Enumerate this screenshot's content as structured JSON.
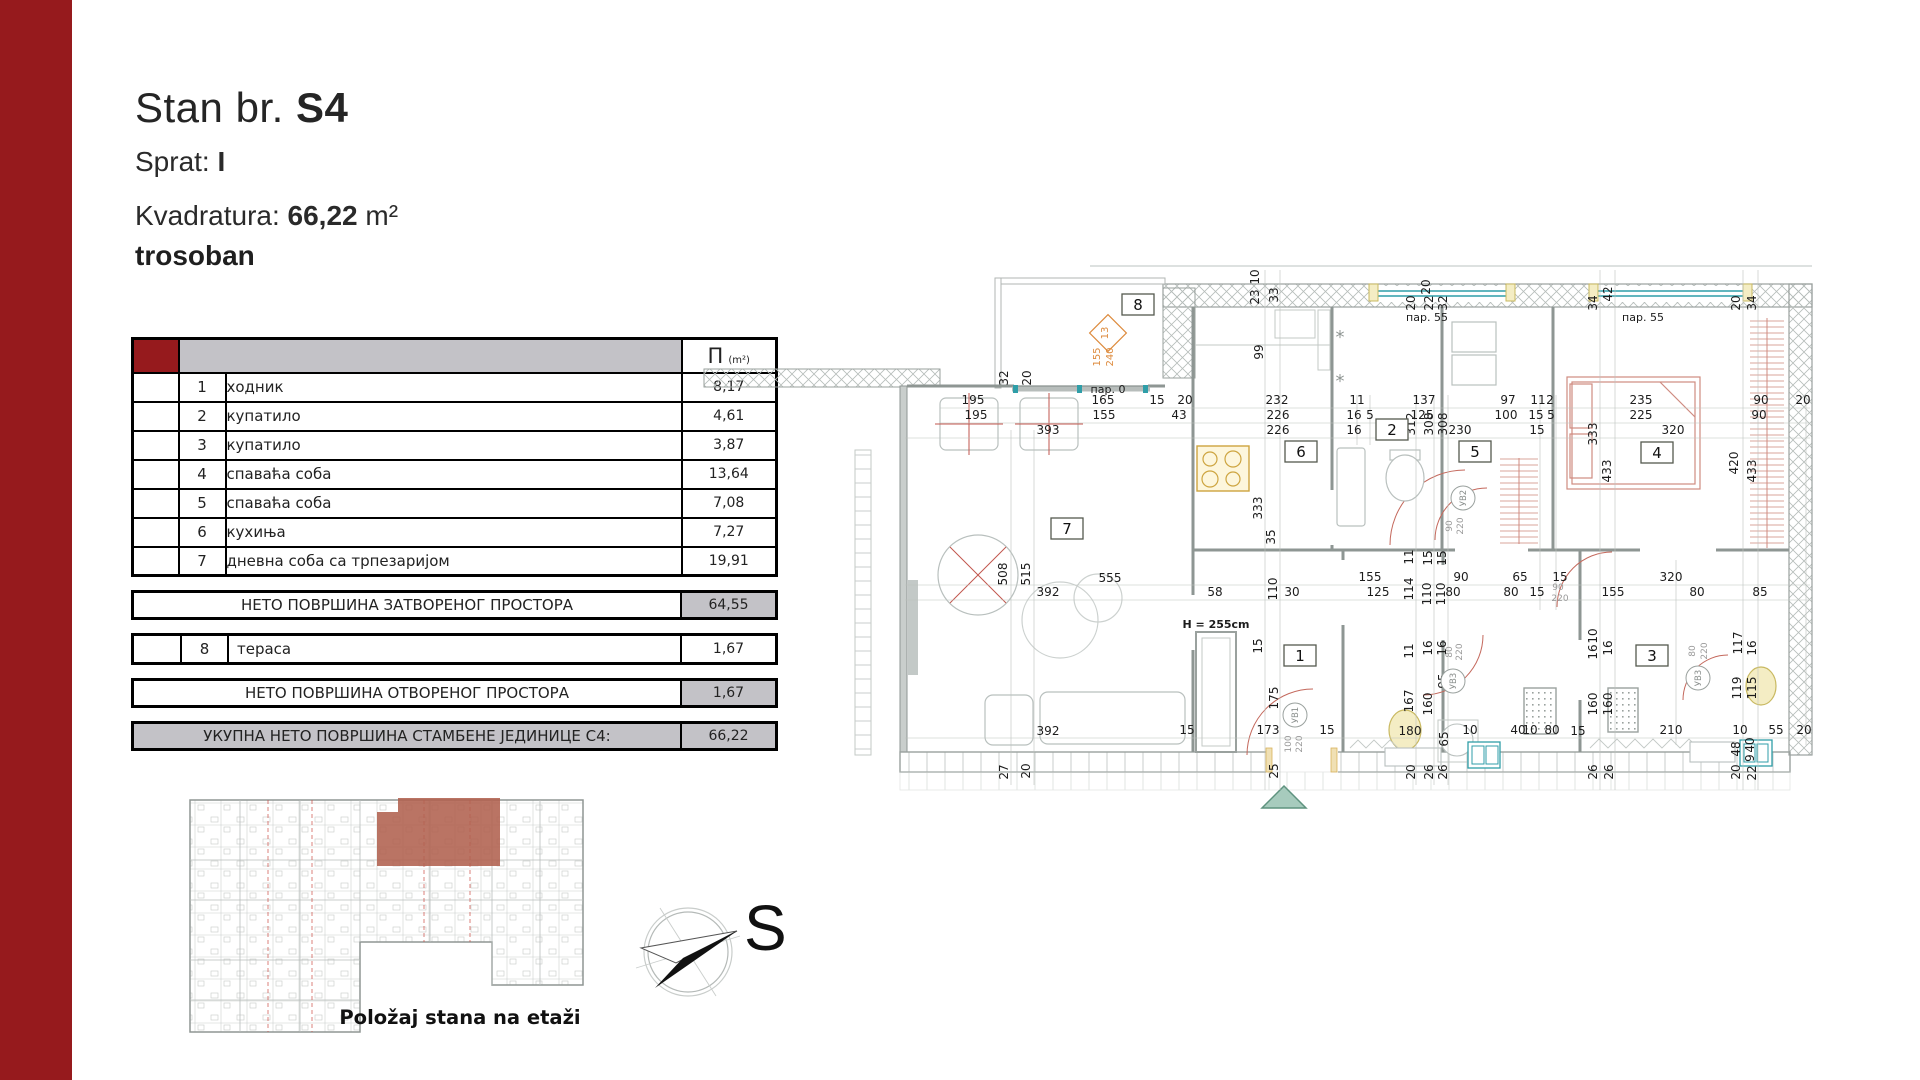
{
  "colors": {
    "accent": "#961a1d",
    "table_gray": "#c3c2c7",
    "highlight": "#b0614f",
    "teal": "#2f9ea8",
    "furniture_red": "#cf8b80",
    "fixture_yellow": "#f4edc4",
    "entry_green": "#a7cbbd"
  },
  "header": {
    "title_label": "Stan br.",
    "unit": "S4",
    "floor_label": "Sprat:",
    "floor": "I",
    "area_label": "Kvadratura:",
    "area": "66,22",
    "area_unit": "m²",
    "apartment_type": "trosoban"
  },
  "table": {
    "area_symbol": "П",
    "area_unit": "(m²)",
    "rows": [
      {
        "num": "1",
        "name": "ходник",
        "area": "8,17"
      },
      {
        "num": "2",
        "name": "купатило",
        "area": "4,61"
      },
      {
        "num": "3",
        "name": "купатило",
        "area": "3,87"
      },
      {
        "num": "4",
        "name": "спаваћа соба",
        "area": "13,64"
      },
      {
        "num": "5",
        "name": "спаваћа соба",
        "area": "7,08"
      },
      {
        "num": "6",
        "name": "кухиња",
        "area": "7,27"
      },
      {
        "num": "7",
        "name": "дневна соба са трпезаријом",
        "area": "19,91"
      }
    ],
    "closed_total": {
      "label": "НЕТО ПОВРШИНА ЗАТВОРЕНОГ ПРОСТОРА",
      "value": "64,55"
    },
    "terrace_row": {
      "num": "8",
      "name": "тераса",
      "area": "1,67"
    },
    "open_total": {
      "label": "НЕТО ПОВРШИНА ОТВОРЕНОГ ПРОСТОРА",
      "value": "1,67"
    },
    "grand_total": {
      "label": "УКУПНА НЕТО ПОВРШИНА СТАМБЕНЕ ЈЕДИНИЦЕ С4:",
      "value": "66,22"
    }
  },
  "mini": {
    "caption": "Položaj stana na etaži"
  },
  "compass": {
    "label": "S"
  },
  "plan": {
    "rooms": [
      {
        "n": "8",
        "x": 1138,
        "y": 305
      },
      {
        "n": "7",
        "x": 1067,
        "y": 529
      },
      {
        "n": "6",
        "x": 1301,
        "y": 452
      },
      {
        "n": "5",
        "x": 1475,
        "y": 452
      },
      {
        "n": "2",
        "x": 1392,
        "y": 430
      },
      {
        "n": "4",
        "x": 1657,
        "y": 453
      },
      {
        "n": "1",
        "x": 1300,
        "y": 656
      },
      {
        "n": "3",
        "x": 1652,
        "y": 656
      }
    ],
    "doors": [
      {
        "t": "УВ1",
        "x": 1295,
        "y": 715
      },
      {
        "t": "УВ2",
        "x": 1463,
        "y": 498
      },
      {
        "t": "УВ3",
        "x": 1453,
        "y": 681
      },
      {
        "t": "УВ3",
        "x": 1698,
        "y": 678
      }
    ],
    "labels": [
      {
        "t": "195",
        "x": 973,
        "y": 404
      },
      {
        "t": "165",
        "x": 1103,
        "y": 404
      },
      {
        "t": "15",
        "x": 1157,
        "y": 404
      },
      {
        "t": "20",
        "x": 1185,
        "y": 404
      },
      {
        "t": "232",
        "x": 1277,
        "y": 404
      },
      {
        "t": "11",
        "x": 1357,
        "y": 404
      },
      {
        "t": "137",
        "x": 1424,
        "y": 404
      },
      {
        "t": "97",
        "x": 1508,
        "y": 404
      },
      {
        "t": "11",
        "x": 1538,
        "y": 404
      },
      {
        "t": "2",
        "x": 1550,
        "y": 404
      },
      {
        "t": "235",
        "x": 1641,
        "y": 404
      },
      {
        "t": "90",
        "x": 1761,
        "y": 404
      },
      {
        "t": "20",
        "x": 1803,
        "y": 404
      },
      {
        "t": "195",
        "x": 976,
        "y": 419
      },
      {
        "t": "155",
        "x": 1104,
        "y": 419
      },
      {
        "t": "43",
        "x": 1179,
        "y": 419
      },
      {
        "t": "226",
        "x": 1278,
        "y": 419
      },
      {
        "t": "16",
        "x": 1354,
        "y": 419
      },
      {
        "t": "5",
        "x": 1370,
        "y": 419
      },
      {
        "t": "125",
        "x": 1422,
        "y": 419
      },
      {
        "t": "100",
        "x": 1506,
        "y": 419
      },
      {
        "t": "15",
        "x": 1536,
        "y": 419
      },
      {
        "t": "5",
        "x": 1551,
        "y": 419
      },
      {
        "t": "225",
        "x": 1641,
        "y": 419
      },
      {
        "t": "90",
        "x": 1759,
        "y": 419
      },
      {
        "t": "393",
        "x": 1048,
        "y": 434
      },
      {
        "t": "226",
        "x": 1278,
        "y": 434
      },
      {
        "t": "16",
        "x": 1354,
        "y": 434
      },
      {
        "t": "230",
        "x": 1460,
        "y": 434
      },
      {
        "t": "15",
        "x": 1537,
        "y": 434
      },
      {
        "t": "320",
        "x": 1673,
        "y": 434
      },
      {
        "t": "312",
        "x": 1415,
        "y": 424,
        "r": 1
      },
      {
        "t": "308",
        "x": 1433,
        "y": 424,
        "r": 1
      },
      {
        "t": "308",
        "x": 1447,
        "y": 424,
        "r": 1
      },
      {
        "t": "333",
        "x": 1597,
        "y": 434,
        "r": 1
      },
      {
        "t": "433",
        "x": 1611,
        "y": 471,
        "r": 1
      },
      {
        "t": "420",
        "x": 1738,
        "y": 463,
        "r": 1
      },
      {
        "t": "433",
        "x": 1756,
        "y": 471,
        "r": 1
      },
      {
        "t": "99",
        "x": 1263,
        "y": 352,
        "r": 1
      },
      {
        "t": "23",
        "x": 1259,
        "y": 297,
        "r": 1
      },
      {
        "t": "10",
        "x": 1259,
        "y": 277,
        "r": 1
      },
      {
        "t": "33",
        "x": 1278,
        "y": 295,
        "r": 1
      },
      {
        "t": "20",
        "x": 1430,
        "y": 287,
        "r": 1
      },
      {
        "t": "20",
        "x": 1415,
        "y": 303,
        "r": 1
      },
      {
        "t": "22",
        "x": 1433,
        "y": 303,
        "r": 1
      },
      {
        "t": "32",
        "x": 1447,
        "y": 303,
        "r": 1
      },
      {
        "t": "34",
        "x": 1597,
        "y": 303,
        "r": 1
      },
      {
        "t": "42",
        "x": 1612,
        "y": 294,
        "r": 1
      },
      {
        "t": "20",
        "x": 1740,
        "y": 303,
        "r": 1
      },
      {
        "t": "34",
        "x": 1756,
        "y": 303,
        "r": 1
      },
      {
        "t": "32",
        "x": 1008,
        "y": 378,
        "r": 1
      },
      {
        "t": "20",
        "x": 1031,
        "y": 378,
        "r": 1
      },
      {
        "t": "333",
        "x": 1262,
        "y": 508,
        "r": 1
      },
      {
        "t": "35",
        "x": 1275,
        "y": 537,
        "r": 1
      },
      {
        "t": "508",
        "x": 1007,
        "y": 574,
        "r": 1
      },
      {
        "t": "515",
        "x": 1030,
        "y": 574,
        "r": 1
      },
      {
        "t": "555",
        "x": 1110,
        "y": 582
      },
      {
        "t": "392",
        "x": 1048,
        "y": 596
      },
      {
        "t": "58",
        "x": 1215,
        "y": 596
      },
      {
        "t": "110",
        "x": 1277,
        "y": 589,
        "r": 1
      },
      {
        "t": "30",
        "x": 1292,
        "y": 596
      },
      {
        "t": "155",
        "x": 1370,
        "y": 581
      },
      {
        "t": "125",
        "x": 1378,
        "y": 596
      },
      {
        "t": "114",
        "x": 1413,
        "y": 589,
        "r": 1
      },
      {
        "t": "110",
        "x": 1431,
        "y": 594,
        "r": 1
      },
      {
        "t": "110",
        "x": 1445,
        "y": 594,
        "r": 1
      },
      {
        "t": "90",
        "x": 1461,
        "y": 581
      },
      {
        "t": "80",
        "x": 1453,
        "y": 596
      },
      {
        "t": "65",
        "x": 1520,
        "y": 581
      },
      {
        "t": "80",
        "x": 1511,
        "y": 596
      },
      {
        "t": "15",
        "x": 1560,
        "y": 581
      },
      {
        "t": "15",
        "x": 1537,
        "y": 596
      },
      {
        "t": "320",
        "x": 1671,
        "y": 581
      },
      {
        "t": "155",
        "x": 1613,
        "y": 596
      },
      {
        "t": "80",
        "x": 1697,
        "y": 596
      },
      {
        "t": "85",
        "x": 1760,
        "y": 596
      },
      {
        "t": "11",
        "x": 1413,
        "y": 557,
        "r": 1
      },
      {
        "t": "15",
        "x": 1432,
        "y": 558,
        "r": 1
      },
      {
        "t": "15",
        "x": 1446,
        "y": 558,
        "r": 1
      },
      {
        "t": "15",
        "x": 1262,
        "y": 646,
        "r": 1
      },
      {
        "t": "11",
        "x": 1413,
        "y": 651,
        "r": 1
      },
      {
        "t": "16",
        "x": 1432,
        "y": 648,
        "r": 1
      },
      {
        "t": "16",
        "x": 1446,
        "y": 648,
        "r": 1
      },
      {
        "t": "16",
        "x": 1597,
        "y": 652,
        "r": 1
      },
      {
        "t": "10",
        "x": 1597,
        "y": 636,
        "r": 1
      },
      {
        "t": "16",
        "x": 1612,
        "y": 648,
        "r": 1
      },
      {
        "t": "117",
        "x": 1742,
        "y": 643,
        "r": 1
      },
      {
        "t": "16",
        "x": 1756,
        "y": 648,
        "r": 1
      },
      {
        "t": "95",
        "x": 1447,
        "y": 681,
        "r": 1
      },
      {
        "t": "167",
        "x": 1413,
        "y": 701,
        "r": 1
      },
      {
        "t": "160",
        "x": 1432,
        "y": 704,
        "r": 1
      },
      {
        "t": "160",
        "x": 1597,
        "y": 704,
        "r": 1
      },
      {
        "t": "160",
        "x": 1612,
        "y": 704,
        "r": 1
      },
      {
        "t": "119",
        "x": 1741,
        "y": 688,
        "r": 1
      },
      {
        "t": "115",
        "x": 1756,
        "y": 688,
        "r": 1
      },
      {
        "t": "175",
        "x": 1278,
        "y": 698,
        "r": 1
      },
      {
        "t": "173",
        "x": 1268,
        "y": 734
      },
      {
        "t": "15",
        "x": 1187,
        "y": 734
      },
      {
        "t": "15",
        "x": 1327,
        "y": 734
      },
      {
        "t": "392",
        "x": 1048,
        "y": 735
      },
      {
        "t": "180",
        "x": 1410,
        "y": 735
      },
      {
        "t": "65",
        "x": 1448,
        "y": 739,
        "r": 1
      },
      {
        "t": "10",
        "x": 1470,
        "y": 734
      },
      {
        "t": "40",
        "x": 1518,
        "y": 734
      },
      {
        "t": "10",
        "x": 1530,
        "y": 734
      },
      {
        "t": "80",
        "x": 1552,
        "y": 734
      },
      {
        "t": "15",
        "x": 1578,
        "y": 735
      },
      {
        "t": "210",
        "x": 1671,
        "y": 734
      },
      {
        "t": "10",
        "x": 1740,
        "y": 734
      },
      {
        "t": "55",
        "x": 1776,
        "y": 734
      },
      {
        "t": "20",
        "x": 1804,
        "y": 734
      },
      {
        "t": "48",
        "x": 1740,
        "y": 749,
        "r": 1
      },
      {
        "t": "40",
        "x": 1754,
        "y": 745,
        "r": 1
      },
      {
        "t": "9",
        "x": 1754,
        "y": 758,
        "r": 1
      },
      {
        "t": "25",
        "x": 1278,
        "y": 771,
        "r": 1
      },
      {
        "t": "27",
        "x": 1008,
        "y": 772,
        "r": 1
      },
      {
        "t": "20",
        "x": 1030,
        "y": 771,
        "r": 1
      },
      {
        "t": "20",
        "x": 1415,
        "y": 772,
        "r": 1
      },
      {
        "t": "26",
        "x": 1433,
        "y": 772,
        "r": 1
      },
      {
        "t": "26",
        "x": 1447,
        "y": 772,
        "r": 1
      },
      {
        "t": "26",
        "x": 1597,
        "y": 772,
        "r": 1
      },
      {
        "t": "26",
        "x": 1613,
        "y": 772,
        "r": 1
      },
      {
        "t": "20",
        "x": 1740,
        "y": 772,
        "r": 1
      },
      {
        "t": "22",
        "x": 1756,
        "y": 773,
        "r": 1
      },
      {
        "t": "90",
        "x": 1452,
        "y": 526,
        "r": 1,
        "c": "g"
      },
      {
        "t": "220",
        "x": 1463,
        "y": 526,
        "r": 1,
        "c": "g"
      },
      {
        "t": "90",
        "x": 1558,
        "y": 590,
        "c": "g"
      },
      {
        "t": "220",
        "x": 1560,
        "y": 601,
        "c": "g"
      },
      {
        "t": "80",
        "x": 1452,
        "y": 652,
        "r": 1,
        "c": "g"
      },
      {
        "t": "220",
        "x": 1462,
        "y": 652,
        "r": 1,
        "c": "g"
      },
      {
        "t": "80",
        "x": 1695,
        "y": 651,
        "r": 1,
        "c": "g"
      },
      {
        "t": "220",
        "x": 1707,
        "y": 651,
        "r": 1,
        "c": "g"
      },
      {
        "t": "100",
        "x": 1291,
        "y": 744,
        "r": 1,
        "c": "g"
      },
      {
        "t": "220",
        "x": 1302,
        "y": 744,
        "r": 1,
        "c": "g"
      },
      {
        "t": "13",
        "x": 1108,
        "y": 333,
        "r": 1,
        "c": "o"
      },
      {
        "t": "155",
        "x": 1100,
        "y": 357,
        "r": 1,
        "c": "o"
      },
      {
        "t": "240",
        "x": 1113,
        "y": 357,
        "r": 1,
        "c": "o"
      },
      {
        "t": "пар. 0",
        "x": 1108,
        "y": 393,
        "c": "p"
      },
      {
        "t": "пар. 55",
        "x": 1427,
        "y": 321,
        "c": "p"
      },
      {
        "t": "пар. 55",
        "x": 1643,
        "y": 321,
        "c": "p"
      },
      {
        "t": "H = 255cm",
        "x": 1216,
        "y": 628,
        "c": "b"
      },
      {
        "t": "*",
        "x": 1340,
        "y": 343,
        "c": "s"
      },
      {
        "t": "*",
        "x": 1340,
        "y": 387,
        "c": "s"
      }
    ]
  }
}
